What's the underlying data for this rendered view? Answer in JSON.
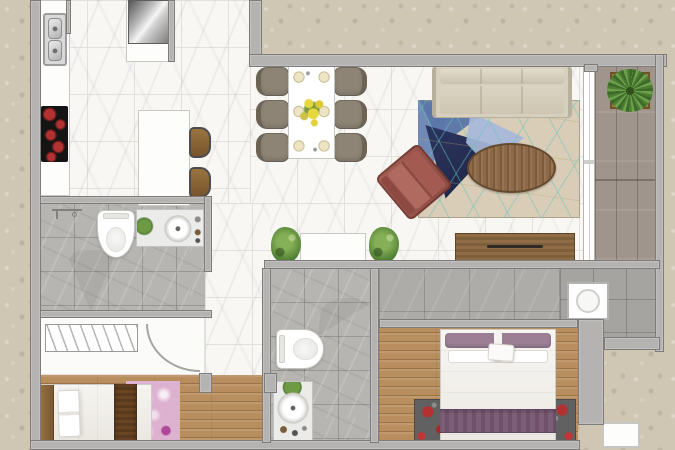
{
  "canvas": {
    "w": 675,
    "h": 450
  },
  "palette": {
    "exterior": "#cfc6b3",
    "wall": "#b4b3b1",
    "walledge": "#7d7c7a",
    "marble": "#f8f7f4",
    "grout": "#e3e1dc",
    "bathtile": "#b6b5b1",
    "corridortile": "#adaca8",
    "utilitytile": "#a5a4a0",
    "woodbed": "#b98e5e",
    "balwood": "#a0958c",
    "sofa": "#d7d0be",
    "sofaedge": "#b7b09d",
    "rugbase": "#d9cdb7",
    "rugnavy": "#151c3e",
    "rugsteel": "#5b76a8",
    "ruglight": "#a6b8da",
    "rugblue": "#6d86b5",
    "rugteal": "rgba(104,196,188,0.55)",
    "tablewood": "#8c6a49",
    "maroon": "#8c4a42",
    "chair": "#8d8475",
    "chairdark": "#6c6355",
    "consolewood": "#8f6c45",
    "pillow": "#9c7f95",
    "runnerpurple": "#7d5e78",
    "runnerbrown": "#6a4524",
    "rugpink": "#ddb2d1",
    "rug2base": "#616161",
    "rug2red": "#b53030",
    "green": "#5f8d3c",
    "greendark": "#3c6a28",
    "pot": "#9b7b46",
    "plate": "#ece4c4",
    "burner": "#b23232",
    "headboard": "#946f41"
  },
  "scene": {
    "rooms": [
      {
        "name": "kitchen-floor",
        "cls": "floor-marble",
        "x": 40,
        "y": 0,
        "w": 210,
        "h": 203
      },
      {
        "name": "living-dining-floor",
        "cls": "floor-marble",
        "x": 250,
        "y": 62,
        "w": 333,
        "h": 206
      },
      {
        "name": "hall-floor",
        "cls": "floor-marble",
        "x": 205,
        "y": 203,
        "w": 65,
        "h": 182
      },
      {
        "name": "balcony-floor",
        "cls": "floor-wood-balcony",
        "x": 595,
        "y": 62,
        "w": 63,
        "h": 200
      },
      {
        "name": "balcony-sliding-door",
        "cls": "slider",
        "x": 583,
        "y": 62,
        "w": 12,
        "h": 200
      },
      {
        "name": "corridor-floor",
        "cls": "floor-corridor",
        "x": 379,
        "y": 266,
        "w": 181,
        "h": 58
      },
      {
        "name": "utility-balcony-floor",
        "cls": "floor-utility",
        "x": 560,
        "y": 266,
        "w": 98,
        "h": 74
      },
      {
        "name": "bathroom1-floor",
        "cls": "floor-bathtile",
        "x": 40,
        "y": 203,
        "w": 165,
        "h": 110
      },
      {
        "name": "closet-floor",
        "cls": "floor-white",
        "x": 40,
        "y": 313,
        "w": 165,
        "h": 62
      },
      {
        "name": "bedroom1-floor",
        "cls": "floor-wood",
        "x": 40,
        "y": 375,
        "w": 231,
        "h": 68
      },
      {
        "name": "bathroom2-floor",
        "cls": "floor-bathtile",
        "x": 270,
        "y": 268,
        "w": 101,
        "h": 175
      },
      {
        "name": "bedroom2-floor",
        "cls": "floor-wood",
        "x": 379,
        "y": 324,
        "w": 199,
        "h": 119
      }
    ],
    "furniture": [
      {
        "name": "kitchen-counter",
        "cls": "counter",
        "x": 40,
        "y": 0,
        "w": 30,
        "h": 196
      },
      {
        "name": "fridge-cabinet",
        "cls": "counter",
        "x": 126,
        "y": 0,
        "w": 46,
        "h": 62
      },
      {
        "name": "refrigerator",
        "cls": "fridge",
        "x": 128,
        "y": 0,
        "w": 41,
        "h": 44
      },
      {
        "name": "kitchen-sink",
        "cls": "sink",
        "x": 43,
        "y": 13,
        "w": 24,
        "h": 53
      },
      {
        "name": "cooktop",
        "cls": "cooktop",
        "x": 41,
        "y": 106,
        "w": 27,
        "h": 56
      },
      {
        "name": "kitchen-island",
        "cls": "counter",
        "x": 138,
        "y": 110,
        "w": 52,
        "h": 96
      },
      {
        "name": "bar-stool-1",
        "cls": "stool",
        "x": 189,
        "y": 127,
        "w": 22,
        "h": 31
      },
      {
        "name": "bar-stool-2",
        "cls": "stool",
        "x": 189,
        "y": 167,
        "w": 22,
        "h": 31
      },
      {
        "name": "dining-chair-1",
        "cls": "chair chair-l",
        "x": 256,
        "y": 67,
        "w": 33,
        "h": 29
      },
      {
        "name": "dining-chair-2",
        "cls": "chair chair-l",
        "x": 256,
        "y": 100,
        "w": 33,
        "h": 29
      },
      {
        "name": "dining-chair-3",
        "cls": "chair chair-l",
        "x": 256,
        "y": 133,
        "w": 33,
        "h": 29
      },
      {
        "name": "dining-chair-4",
        "cls": "chair chair-r",
        "x": 334,
        "y": 67,
        "w": 33,
        "h": 29
      },
      {
        "name": "dining-chair-5",
        "cls": "chair chair-r",
        "x": 334,
        "y": 100,
        "w": 33,
        "h": 29
      },
      {
        "name": "dining-chair-6",
        "cls": "chair chair-r",
        "x": 334,
        "y": 133,
        "w": 33,
        "h": 29
      },
      {
        "name": "dining-table",
        "cls": "dtable",
        "x": 288,
        "y": 64,
        "w": 47,
        "h": 95
      },
      {
        "name": "living-rug",
        "cls": "rug-living",
        "x": 418,
        "y": 100,
        "w": 162,
        "h": 118
      },
      {
        "name": "rug-triangle-blue",
        "cls": "tri tri-blue",
        "x": 418,
        "y": 100,
        "w": 30,
        "h": 100
      },
      {
        "name": "rug-triangle-steel",
        "cls": "tri tri-steel",
        "x": 420,
        "y": 100,
        "w": 78,
        "h": 46
      },
      {
        "name": "rug-triangle-navy",
        "cls": "tri tri-navy",
        "x": 424,
        "y": 122,
        "w": 72,
        "h": 78
      },
      {
        "name": "rug-triangle-light",
        "cls": "tri tri-light",
        "x": 466,
        "y": 112,
        "w": 58,
        "h": 56
      },
      {
        "name": "rug-pattern-lines",
        "cls": "rug-lines",
        "x": 418,
        "y": 100,
        "w": 162,
        "h": 118
      },
      {
        "name": "sofa",
        "cls": "sofa",
        "x": 432,
        "y": 66,
        "w": 140,
        "h": 52
      },
      {
        "name": "coffee-table",
        "cls": "ctable",
        "x": 467,
        "y": 143,
        "w": 89,
        "h": 50
      },
      {
        "name": "armchair",
        "cls": "armchair",
        "x": 386,
        "y": 154,
        "w": 56,
        "h": 56,
        "rot": -40
      },
      {
        "name": "tv-console",
        "cls": "tvconsole",
        "x": 455,
        "y": 233,
        "w": 120,
        "h": 28
      },
      {
        "name": "entry-console",
        "cls": "counter",
        "x": 300,
        "y": 233,
        "w": 66,
        "h": 28
      },
      {
        "name": "entry-plant-left",
        "cls": "plant",
        "x": 271,
        "y": 227,
        "w": 30,
        "h": 36
      },
      {
        "name": "entry-plant-right",
        "cls": "plant",
        "x": 369,
        "y": 227,
        "w": 30,
        "h": 36
      },
      {
        "name": "balcony-plant",
        "cls": "plant-pot",
        "x": 610,
        "y": 72,
        "w": 40,
        "h": 37
      },
      {
        "name": "washing-machine",
        "cls": "washer",
        "x": 567,
        "y": 282,
        "w": 42,
        "h": 38
      },
      {
        "name": "shower-head",
        "cls": "shower-head",
        "x": 52,
        "y": 209,
        "w": 30,
        "h": 12
      },
      {
        "name": "shower-door-swing-1",
        "cls": "fan fan-down",
        "x": 68,
        "y": 250,
        "w": 46,
        "h": 62
      },
      {
        "name": "toilet-1",
        "cls": "toilet toilet-v",
        "x": 97,
        "y": 210,
        "w": 38,
        "h": 48
      },
      {
        "name": "vanity-sink-1",
        "cls": "vanity vanity-h",
        "x": 136,
        "y": 209,
        "w": 68,
        "h": 38
      },
      {
        "name": "wardrobe-rail",
        "cls": "rail",
        "x": 45,
        "y": 324,
        "w": 93,
        "h": 28
      },
      {
        "name": "closet-door-arc",
        "cls": "door-arc",
        "x": 146,
        "y": 324,
        "w": 54,
        "h": 48
      },
      {
        "name": "bedroom1-rug",
        "cls": "rug-pink",
        "x": 126,
        "y": 381,
        "w": 54,
        "h": 62
      },
      {
        "name": "bed-1",
        "cls": "bed bed-h",
        "x": 40,
        "y": 384,
        "w": 112,
        "h": 59
      },
      {
        "name": "bed-1-runner",
        "cls": "runner-brown",
        "x": 114,
        "y": 384,
        "w": 23,
        "h": 59
      },
      {
        "name": "shower-door-swing-2",
        "cls": "fan fan-left",
        "x": 318,
        "y": 298,
        "w": 52,
        "h": 38
      },
      {
        "name": "toilet-2",
        "cls": "toilet toilet-h",
        "x": 276,
        "y": 329,
        "w": 48,
        "h": 40
      },
      {
        "name": "vanity-sink-2",
        "cls": "vanity vanity-v",
        "x": 273,
        "y": 381,
        "w": 40,
        "h": 60
      },
      {
        "name": "bedroom2-rug",
        "cls": "rug-red",
        "x": 414,
        "y": 399,
        "w": 162,
        "h": 44
      },
      {
        "name": "bed-2",
        "cls": "bed bed-v",
        "x": 440,
        "y": 329,
        "w": 116,
        "h": 114
      },
      {
        "name": "bed-2-runner",
        "cls": "runner-purple",
        "x": 440,
        "y": 409,
        "w": 116,
        "h": 24
      },
      {
        "name": "bed-2-cushion",
        "cls": "cushion",
        "x": 488,
        "y": 344,
        "w": 26,
        "h": 17,
        "rot": 4
      },
      {
        "name": "ac-unit",
        "cls": "acunit",
        "x": 602,
        "y": 422,
        "w": 38,
        "h": 26
      }
    ],
    "walls": [
      {
        "name": "wall-outer-left",
        "cls": "wall",
        "x": 30,
        "y": 0,
        "w": 11,
        "h": 450
      },
      {
        "name": "wall-outer-bottom",
        "cls": "wall",
        "x": 30,
        "y": 440,
        "w": 550,
        "h": 10
      },
      {
        "name": "wall-top-notch-left",
        "cls": "wall",
        "x": 249,
        "y": 0,
        "w": 13,
        "h": 64
      },
      {
        "name": "wall-top",
        "cls": "wall",
        "x": 249,
        "y": 54,
        "w": 418,
        "h": 13
      },
      {
        "name": "wall-balcony-jamb",
        "cls": "wall",
        "x": 584,
        "y": 64,
        "w": 14,
        "h": 8
      },
      {
        "name": "wall-outer-right",
        "cls": "wall",
        "x": 655,
        "y": 54,
        "w": 9,
        "h": 298
      },
      {
        "name": "wall-entry",
        "cls": "wall",
        "x": 264,
        "y": 260,
        "w": 396,
        "h": 9
      },
      {
        "name": "wall-bath1-top",
        "cls": "wall",
        "x": 40,
        "y": 196,
        "w": 172,
        "h": 8
      },
      {
        "name": "wall-bath1-right",
        "cls": "wall",
        "x": 204,
        "y": 196,
        "w": 8,
        "h": 76
      },
      {
        "name": "wall-bath1-bottom",
        "cls": "wall",
        "x": 40,
        "y": 310,
        "w": 172,
        "h": 8
      },
      {
        "name": "wall-bath2-left",
        "cls": "wall",
        "x": 262,
        "y": 268,
        "w": 9,
        "h": 175
      },
      {
        "name": "wall-bath2-right",
        "cls": "wall",
        "x": 370,
        "y": 268,
        "w": 9,
        "h": 175
      },
      {
        "name": "wall-bedroom2-top",
        "cls": "wall",
        "x": 379,
        "y": 319,
        "w": 199,
        "h": 9
      },
      {
        "name": "wall-bedroom2-right",
        "cls": "wall",
        "x": 578,
        "y": 319,
        "w": 26,
        "h": 106
      },
      {
        "name": "wall-utility-bottom",
        "cls": "wall",
        "x": 604,
        "y": 337,
        "w": 56,
        "h": 13
      },
      {
        "name": "wall-bedroom1-jamb-left",
        "cls": "wall",
        "x": 199,
        "y": 373,
        "w": 13,
        "h": 20
      },
      {
        "name": "wall-bedroom1-jamb-right",
        "cls": "wall",
        "x": 264,
        "y": 373,
        "w": 13,
        "h": 20
      },
      {
        "name": "wall-kitchen-stub",
        "cls": "wall",
        "x": 66,
        "y": 0,
        "w": 5,
        "h": 34
      },
      {
        "name": "wall-fridge-side",
        "cls": "wall",
        "x": 168,
        "y": 0,
        "w": 7,
        "h": 62
      }
    ]
  }
}
